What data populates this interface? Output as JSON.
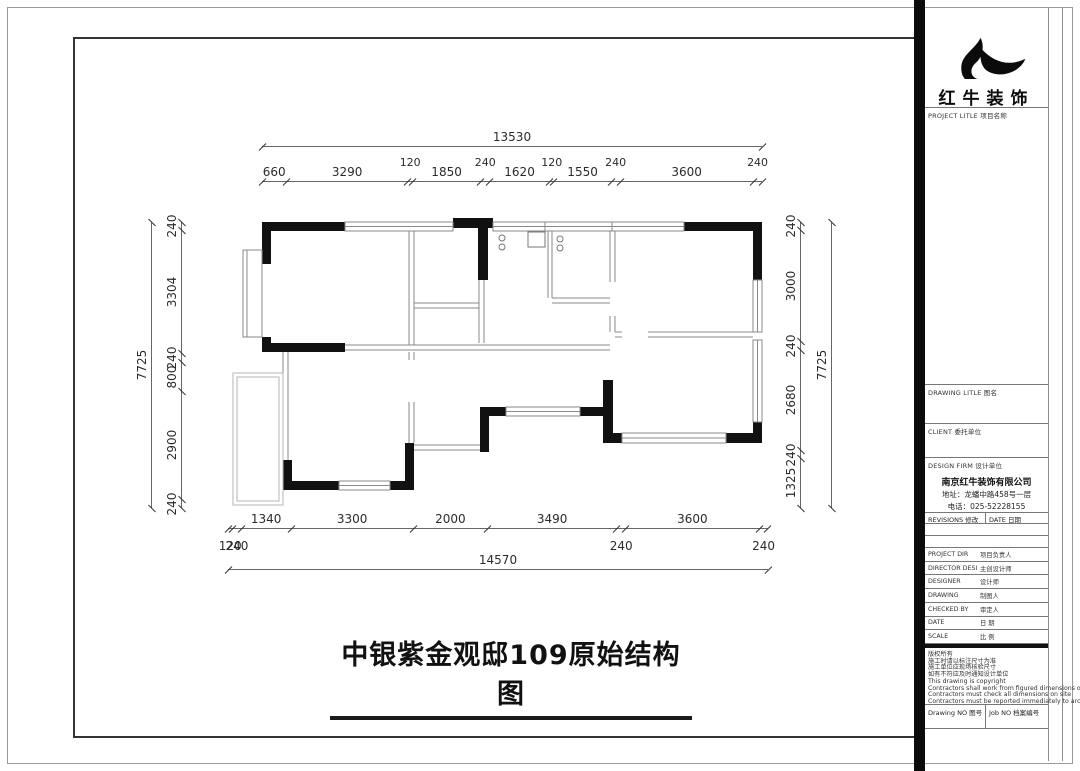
{
  "page": {
    "title": "中银紫金观邸109原始结构图"
  },
  "brand": {
    "name": "红牛装饰",
    "project_label": "PROJECT LITLE  项目名称"
  },
  "titleblock": {
    "drawing_title_label": "DRAWING LITLE  图名",
    "client_label": "CLIENT  委托单位",
    "design_firm_label": "DESIGN FIRM  设计单位",
    "company_name": "南京红牛装饰有限公司",
    "company_address": "地址：龙蟠中路458号一层",
    "company_phone": "电话：025-52228155",
    "revisions_label": "REVISIONS  修改",
    "revisions_date_label": "DATE 日期",
    "rows": [
      {
        "en": "PROJECT DIR",
        "cn": "项目负责人"
      },
      {
        "en": "DIRECTOR DESI",
        "cn": "主创设计师"
      },
      {
        "en": "DESIGNER",
        "cn": "设计师"
      },
      {
        "en": "DRAWING",
        "cn": "制图人"
      },
      {
        "en": "CHECKED BY",
        "cn": "审定人"
      },
      {
        "en": "DATE",
        "cn": "日 期"
      },
      {
        "en": "SCALE",
        "cn": "比 例"
      }
    ],
    "notes": [
      "版权所有",
      "施工时请以标注尺寸为准",
      "施工单位应现场核验尺寸",
      "如有不符应及时通知设计单位",
      "This drawing is copyright",
      "Contractors shall work from figured dimensions only",
      "Contractors must check all dimensions on site",
      "Contractors must be reported immediately to architects"
    ],
    "drawing_no_label": "Drawing NO  图号",
    "job_no_label": "Job NO  档案编号"
  },
  "dimensions": {
    "top": {
      "total": "13530",
      "segments": [
        660,
        3290,
        120,
        1850,
        240,
        1620,
        120,
        1550,
        240,
        3600,
        240
      ]
    },
    "left": {
      "total": "7725",
      "segments": [
        240,
        3304,
        240,
        800,
        2900,
        240
      ]
    },
    "right": {
      "total": "7725",
      "segments": [
        240,
        3000,
        240,
        2680,
        240,
        1325
      ]
    },
    "bottom": {
      "total": "14570",
      "segments": [
        120,
        240,
        1340,
        3300,
        2000,
        3490,
        240,
        3600,
        240
      ]
    }
  },
  "colors": {
    "wall": "#111111",
    "partition": "#8a8a8a",
    "dim_line": "#555555",
    "balcony": "#b5b5b5",
    "frame": "#333333"
  }
}
